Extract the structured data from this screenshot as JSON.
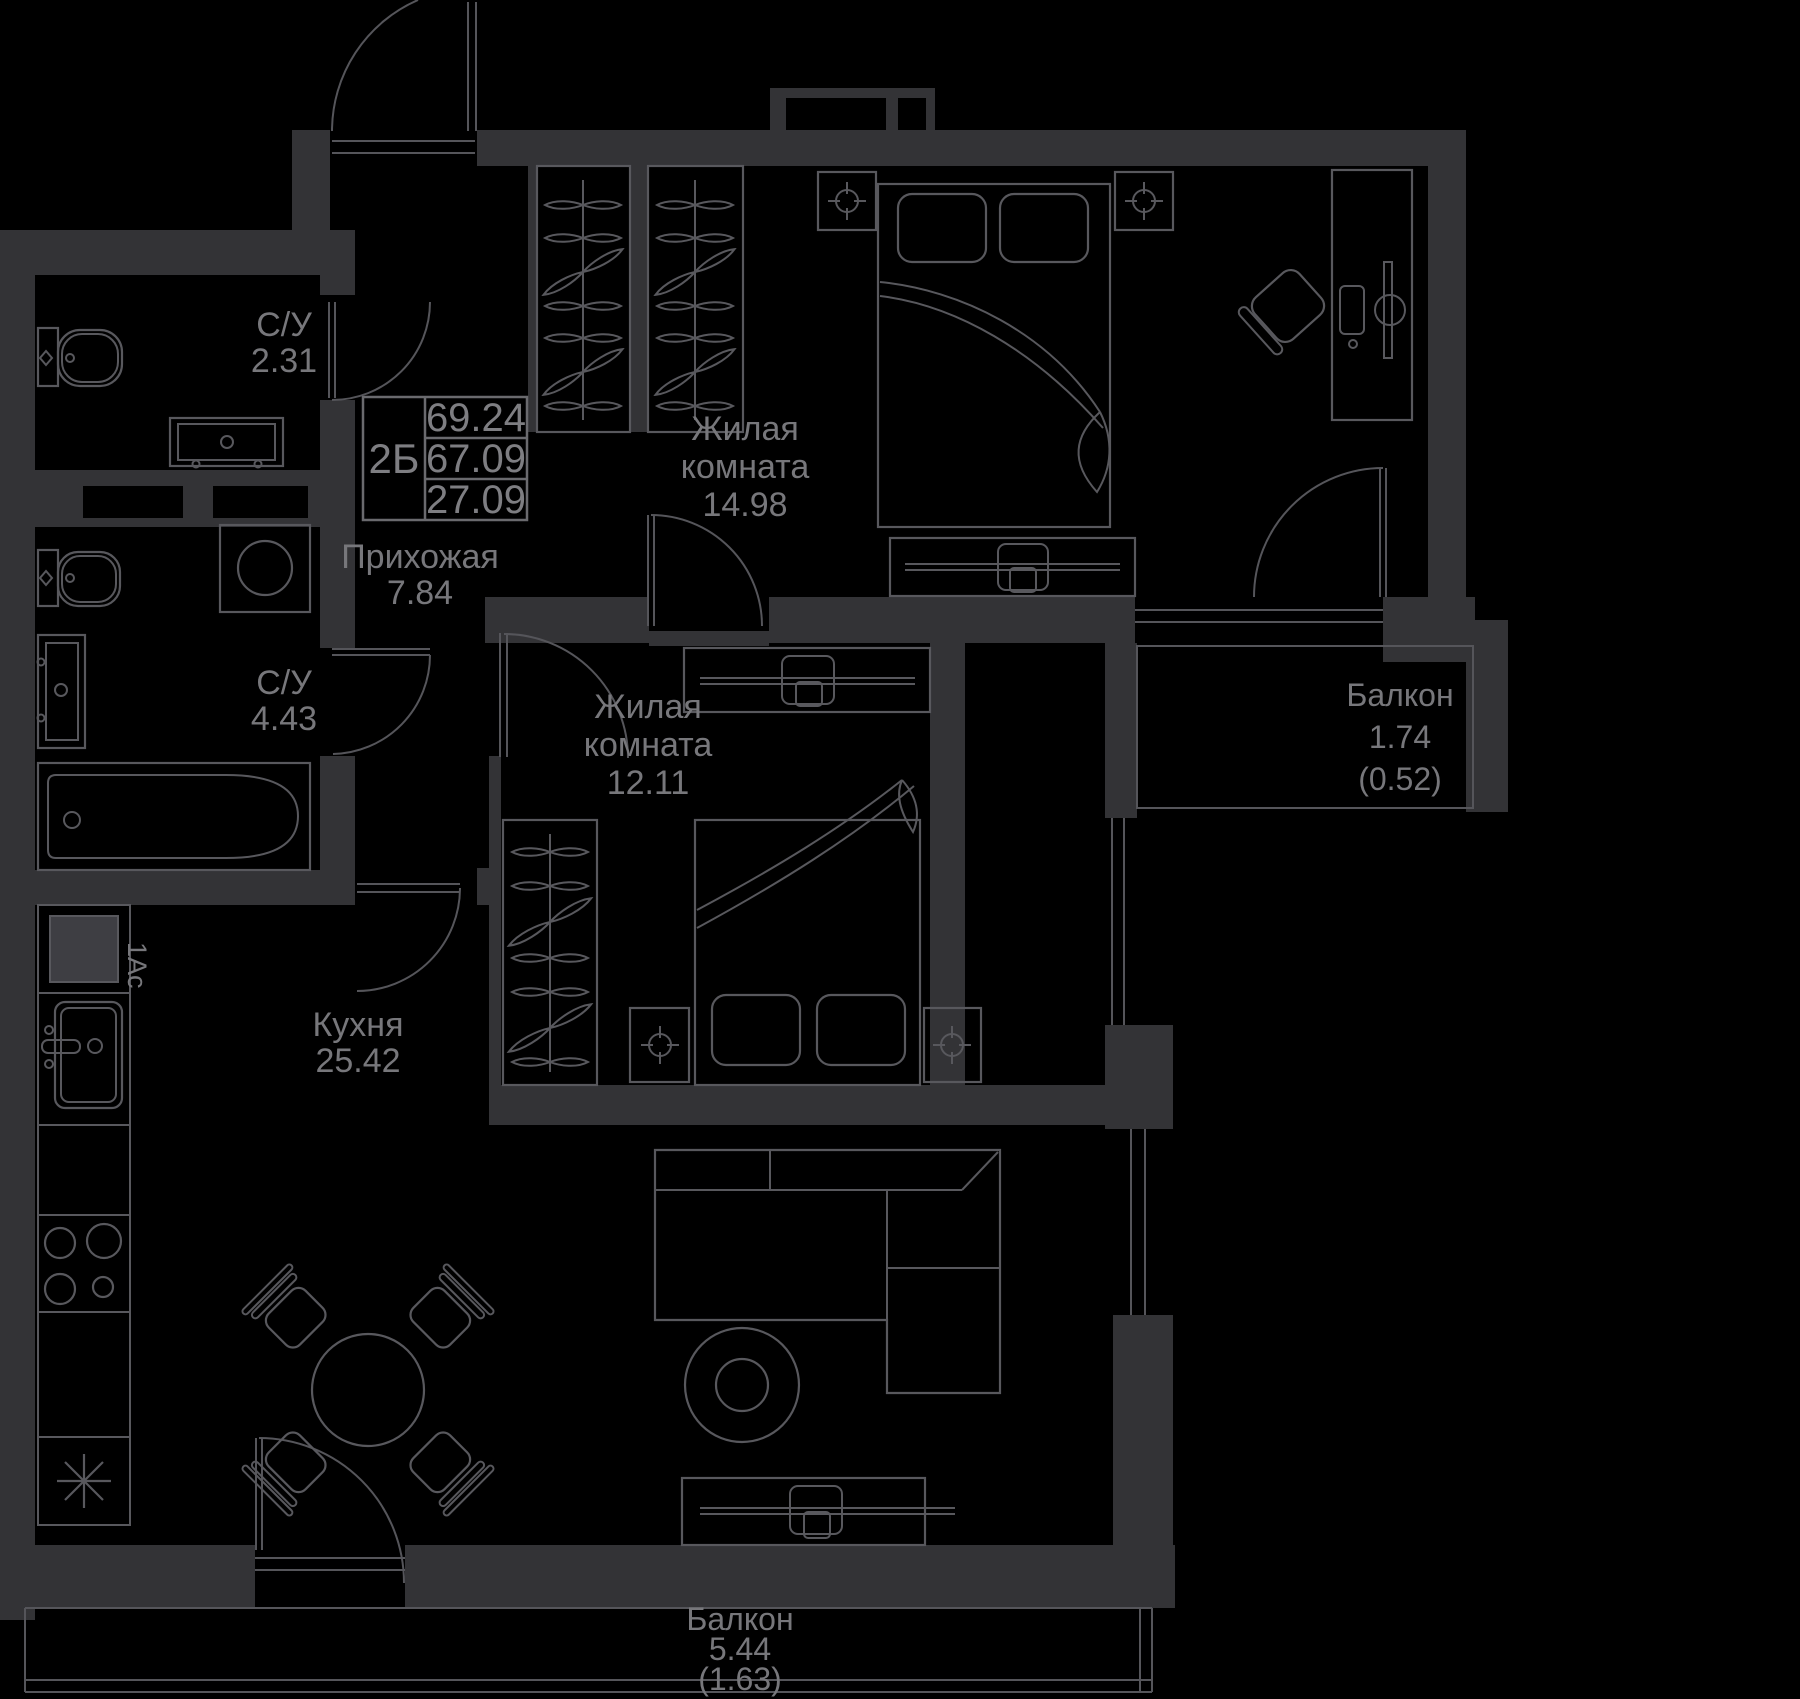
{
  "colors": {
    "background": "#000000",
    "wall": "#333336",
    "line": "#58585d",
    "text": "#77777b"
  },
  "info_box": {
    "unit": "2Б",
    "total_area": "69.24",
    "living_area": "67.09",
    "rooms_area": "27.09"
  },
  "rooms": [
    {
      "id": "bathroom-1",
      "name": "С/У",
      "area": "2.31"
    },
    {
      "id": "bathroom-2",
      "name": "С/У",
      "area": "4.43"
    },
    {
      "id": "hallway",
      "name": "Прихожая",
      "area": "7.84"
    },
    {
      "id": "bedroom-1",
      "name_lines": [
        "Жилая",
        "комната"
      ],
      "area": "14.98"
    },
    {
      "id": "bedroom-2",
      "name_lines": [
        "Жилая",
        "комната"
      ],
      "area": "12.11"
    },
    {
      "id": "kitchen-living",
      "name": "Кухня",
      "area": "25.42"
    },
    {
      "id": "balcony-right",
      "name": "Балкон",
      "area": "1.74",
      "area_reduced": "(0.52)"
    },
    {
      "id": "balcony-bottom",
      "name": "Балкон",
      "area": "5.44",
      "area_reduced": "(1.63)"
    }
  ],
  "annotations": {
    "riser": "1Ас"
  }
}
